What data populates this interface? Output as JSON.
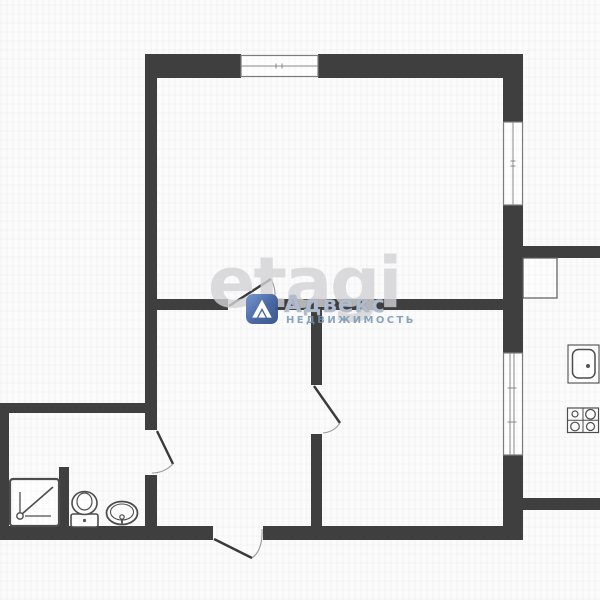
{
  "watermark": {
    "brand": "etagi",
    "agency": "Адвекс",
    "agency_subtitle": "НЕДВИЖИМОСТЬ"
  },
  "colors": {
    "wall": "#3f3f3f",
    "fixture_outline": "#4d4d4d",
    "window_line": "#8a8a8a",
    "background": "#fbfbfb",
    "watermark_gray": "#d2d2d4",
    "badge_blue": "#3c5d9d",
    "agency_text": "#b2becf",
    "agency_subtitle_text": "#7494b5"
  },
  "plan": {
    "type": "apartment-floor-plan",
    "window_count": 3,
    "door_count": 4,
    "fixture_icons": [
      "shower-tray-icon",
      "toilet-icon",
      "washbasin-icon",
      "kitchen-sink-icon",
      "stove-4-burner-icon",
      "vent-duct-icon"
    ]
  }
}
